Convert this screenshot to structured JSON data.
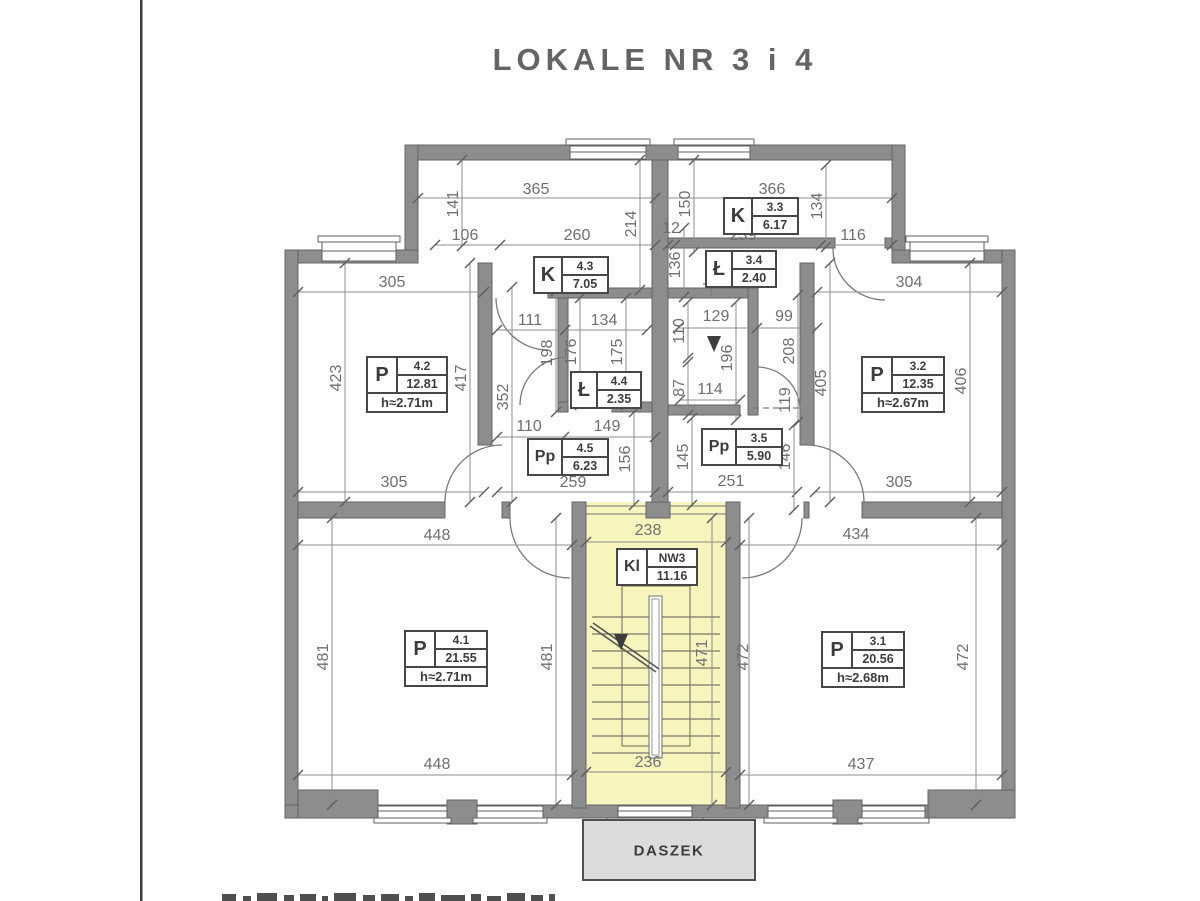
{
  "title": "LOKALE NR 3 i 4",
  "canopy_label": "DASZEK",
  "colors": {
    "wall": "#8d8d8d",
    "stair_fill": "#f7f5bd",
    "canopy_fill": "#dcdcdc",
    "dim_line": "#8c8c8c",
    "dim_text": "#6f6f6f",
    "label_text": "#3c3c3c",
    "title_text": "#646464"
  },
  "rooms": [
    {
      "code": "P",
      "num": "4.2",
      "area": "12.81",
      "h": "h≈2.71m"
    },
    {
      "code": "K",
      "num": "4.3",
      "area": "7.05"
    },
    {
      "code": "Ł",
      "num": "4.4",
      "area": "2.35"
    },
    {
      "code": "Pp",
      "num": "4.5",
      "area": "6.23"
    },
    {
      "code": "P",
      "num": "4.1",
      "area": "21.55",
      "h": "h≈2.71m"
    },
    {
      "code": "K",
      "num": "3.3",
      "area": "6.17"
    },
    {
      "code": "Ł",
      "num": "3.4",
      "area": "2.40"
    },
    {
      "code": "Pp",
      "num": "3.5",
      "area": "5.90"
    },
    {
      "code": "P",
      "num": "3.2",
      "area": "12.35",
      "h": "h≈2.67m"
    },
    {
      "code": "P",
      "num": "3.1",
      "area": "20.56",
      "h": "h≈2.68m"
    },
    {
      "code": "Kl",
      "num": "NW3",
      "area": "11.16"
    }
  ],
  "dims": [
    "365",
    "366",
    "141",
    "106",
    "260",
    "214",
    "12",
    "150",
    "239",
    "134",
    "116",
    "136",
    "305",
    "304",
    "111",
    "134",
    "110",
    "129",
    "99",
    "423",
    "417",
    "352",
    "198",
    "176",
    "175",
    "196",
    "208",
    "87",
    "114",
    "119",
    "405",
    "406",
    "110",
    "149",
    "156",
    "145",
    "146",
    "259",
    "251",
    "305",
    "305",
    "448",
    "238",
    "434",
    "481",
    "481",
    "471",
    "472",
    "472",
    "448",
    "236",
    "437"
  ]
}
